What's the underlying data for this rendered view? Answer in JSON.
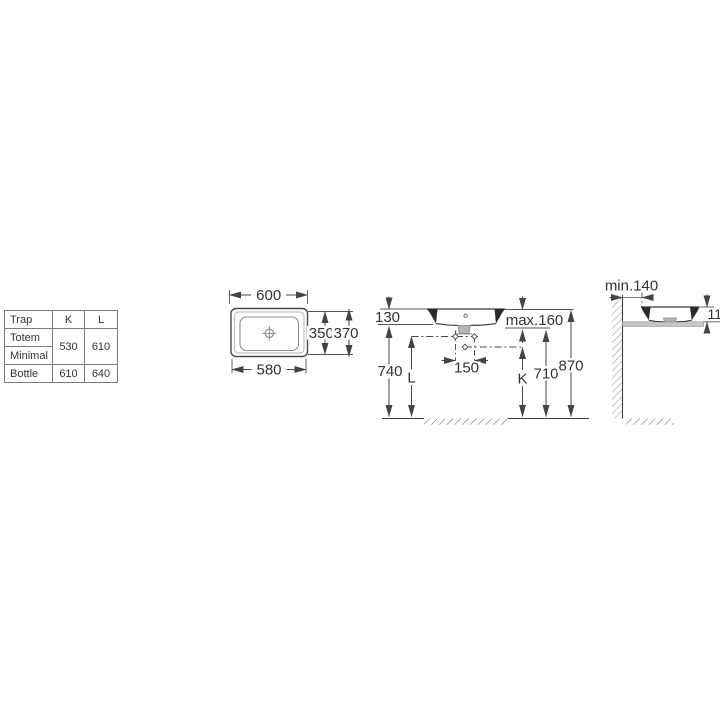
{
  "table": {
    "col_headers": [
      "Trap",
      "K",
      "L"
    ],
    "row_labels": [
      "Totem",
      "Minimal",
      "Bottle"
    ],
    "totem_minimal": {
      "k": "530",
      "l": "610"
    },
    "bottle": {
      "k": "610",
      "l": "640"
    }
  },
  "top_view": {
    "dim_width_rim": "600",
    "dim_width_base": "580",
    "dim_depth_inner": "350",
    "dim_depth_rim": "370"
  },
  "front_view": {
    "dim_basin_height": "130",
    "dim_max": "max.160",
    "dim_floor_to_underside": "740",
    "dim_l": "L",
    "dim_centers": "150",
    "dim_k": "K",
    "dim_supply": "710",
    "dim_rim_height": "870"
  },
  "side_view": {
    "dim_wall": "min.140",
    "dim_above_counter": "110"
  }
}
